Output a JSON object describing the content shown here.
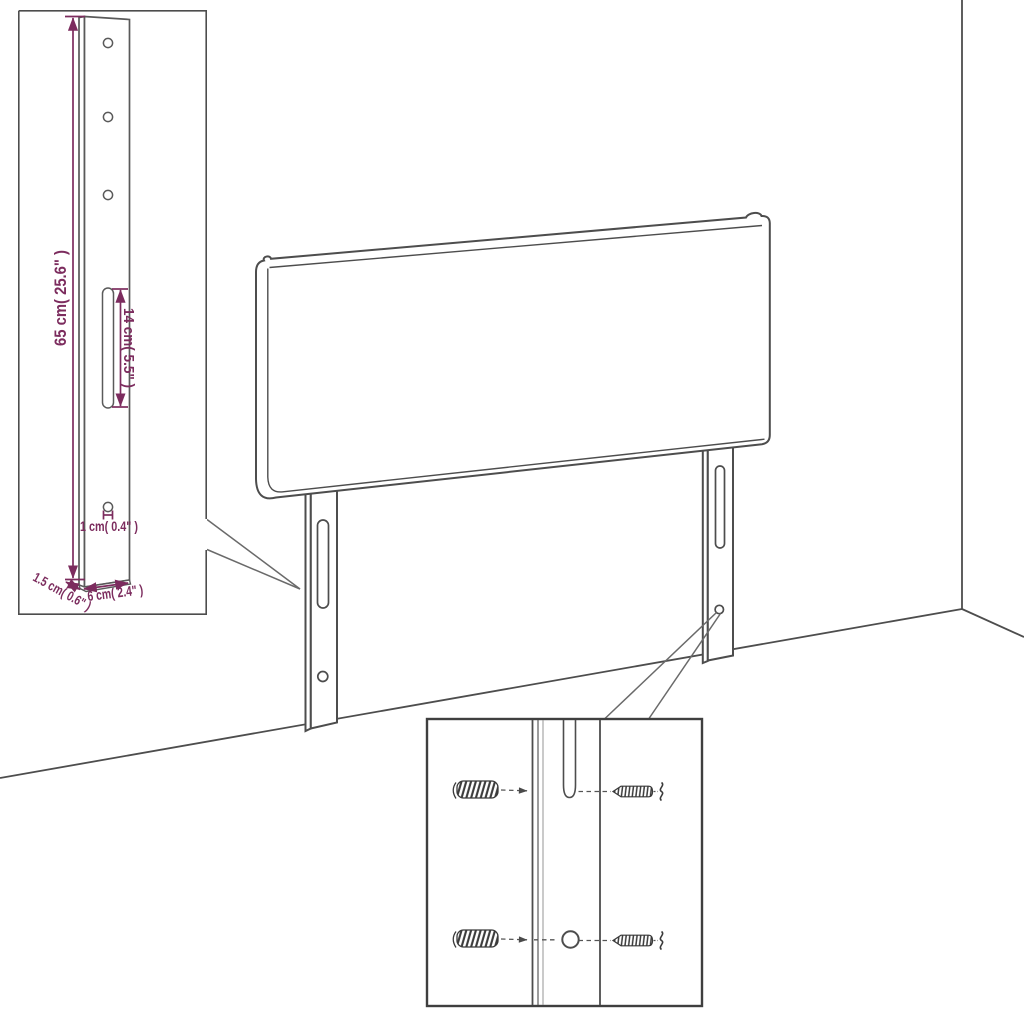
{
  "diagram": {
    "kind": "headboard-dimension-diagram",
    "colors": {
      "drawing_line": "#4d4d4d",
      "dimension": "#7c2c5e",
      "inset_border": "#3f3f3f",
      "background": "#ffffff"
    },
    "insets": {
      "leg_detail": {
        "labels": {
          "height": "65 cm( 25.6\" )",
          "slot": "14 cm( 5.5\" )",
          "hole": "1 cm( 0.4\" )",
          "depth": "1.5 cm( 0.6\" )",
          "width": "6 cm( 2.4\" )"
        }
      },
      "mounting_detail": {
        "parts": [
          "wall-plug-icon",
          "screw-icon",
          "wall-plug-icon",
          "screw-icon"
        ]
      }
    }
  }
}
